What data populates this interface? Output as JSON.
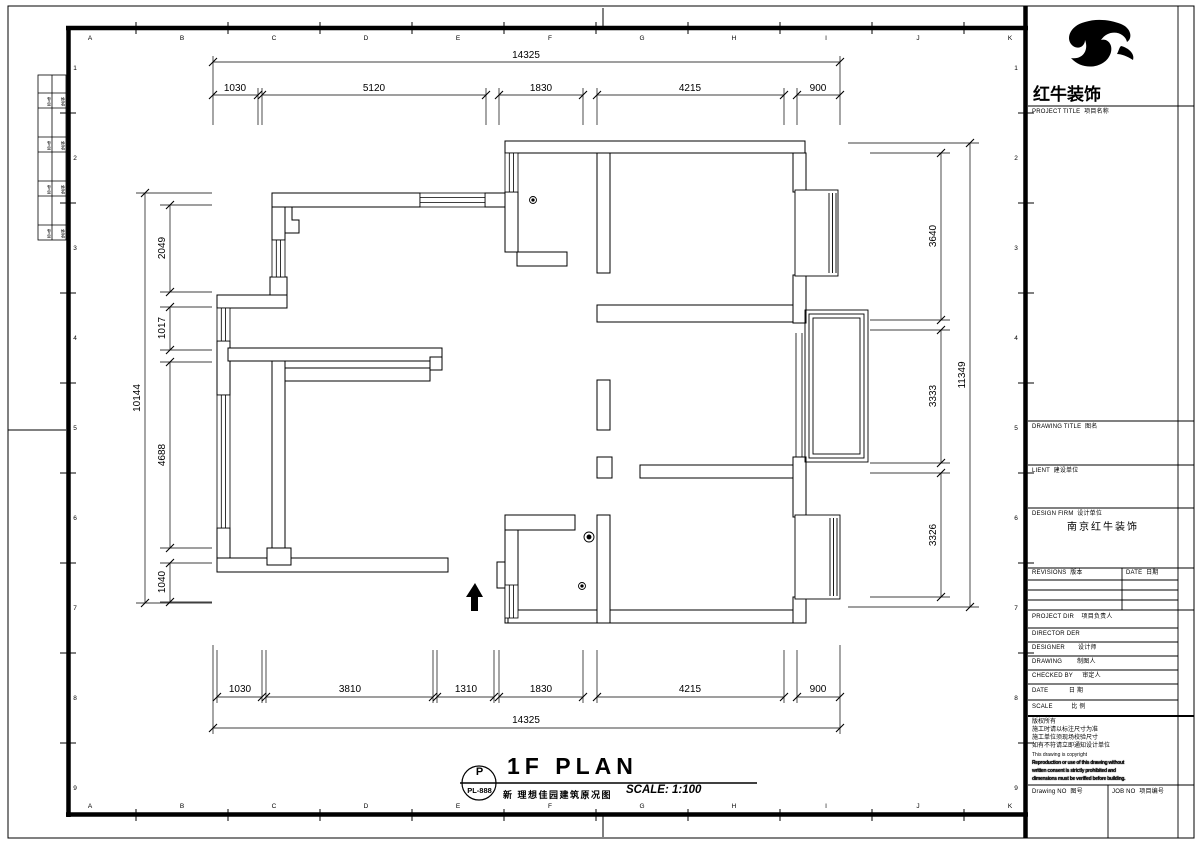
{
  "sheet": {
    "grid_letters": [
      "A",
      "B",
      "C",
      "D",
      "E",
      "F",
      "G",
      "H",
      "I",
      "J",
      "K"
    ],
    "grid_numbers": [
      "1",
      "2",
      "3",
      "4",
      "5",
      "6",
      "7",
      "8",
      "9"
    ]
  },
  "signature_strip": {
    "rows": [
      {
        "left": "专业",
        "right": "姓名"
      },
      {
        "left": "专业",
        "right": "姓名"
      },
      {
        "left": "专业",
        "right": "姓名"
      },
      {
        "left": "专业",
        "right": "姓名"
      }
    ]
  },
  "dimensions": {
    "top_overall": "14325",
    "top_segments": [
      "1030",
      "5120",
      "1830",
      "4215",
      "900"
    ],
    "bottom_segments": [
      "1030",
      "3810",
      "1310",
      "1830",
      "4215",
      "900"
    ],
    "bottom_overall": "14325",
    "left_overall": "10144",
    "left_segments": [
      "2049",
      "1017",
      "4688",
      "1040"
    ],
    "right_segments": [
      "3640",
      "3333",
      "3326"
    ],
    "right_overall": "11349"
  },
  "title_block": {
    "brand": "红牛装饰",
    "project_title_label": "PROJECT TITLE  项目名称",
    "drawing_title_label": "DRAWING TITLE  图名",
    "client_label": "LIENT  建设单位",
    "design_firm_label": "DESIGN FIRM  设计单位",
    "design_firm_value": "南京红牛装饰",
    "revisions_label": "REVISIONS  版本",
    "revision_date_label": "DATE  日期",
    "project_dir_label": "PROJECT DIR    项目负责人",
    "director_label": "DIRECTOR DER",
    "designer_label": "DESIGNER       设计师",
    "drawing_label": "DRAWING        制图人",
    "checked_by_label": "CHECKED BY     审定人",
    "date_label": "DATE           日 期",
    "scale_label": "SCALE          比 例",
    "copyright_lines": [
      "版权所有",
      "施工时请以标注尺寸为准",
      "施工单位须现场校验尺寸",
      "如有不符请立即通知设计单位",
      "This drawing is copyright",
      "Reproduction or use of this drawing without",
      "written consent is strictly prohibited and",
      "dimensions must be verified before building."
    ],
    "drawing_no_label": "Drawing NO  图号",
    "job_no_label": "JOB NO  项目编号"
  },
  "footer": {
    "stamp_top": "P",
    "stamp_code": "PL-888",
    "plan_title": "1F PLAN",
    "plan_subtitle": "新 理想佳园建筑原况图",
    "scale_text": "SCALE: 1:100"
  }
}
